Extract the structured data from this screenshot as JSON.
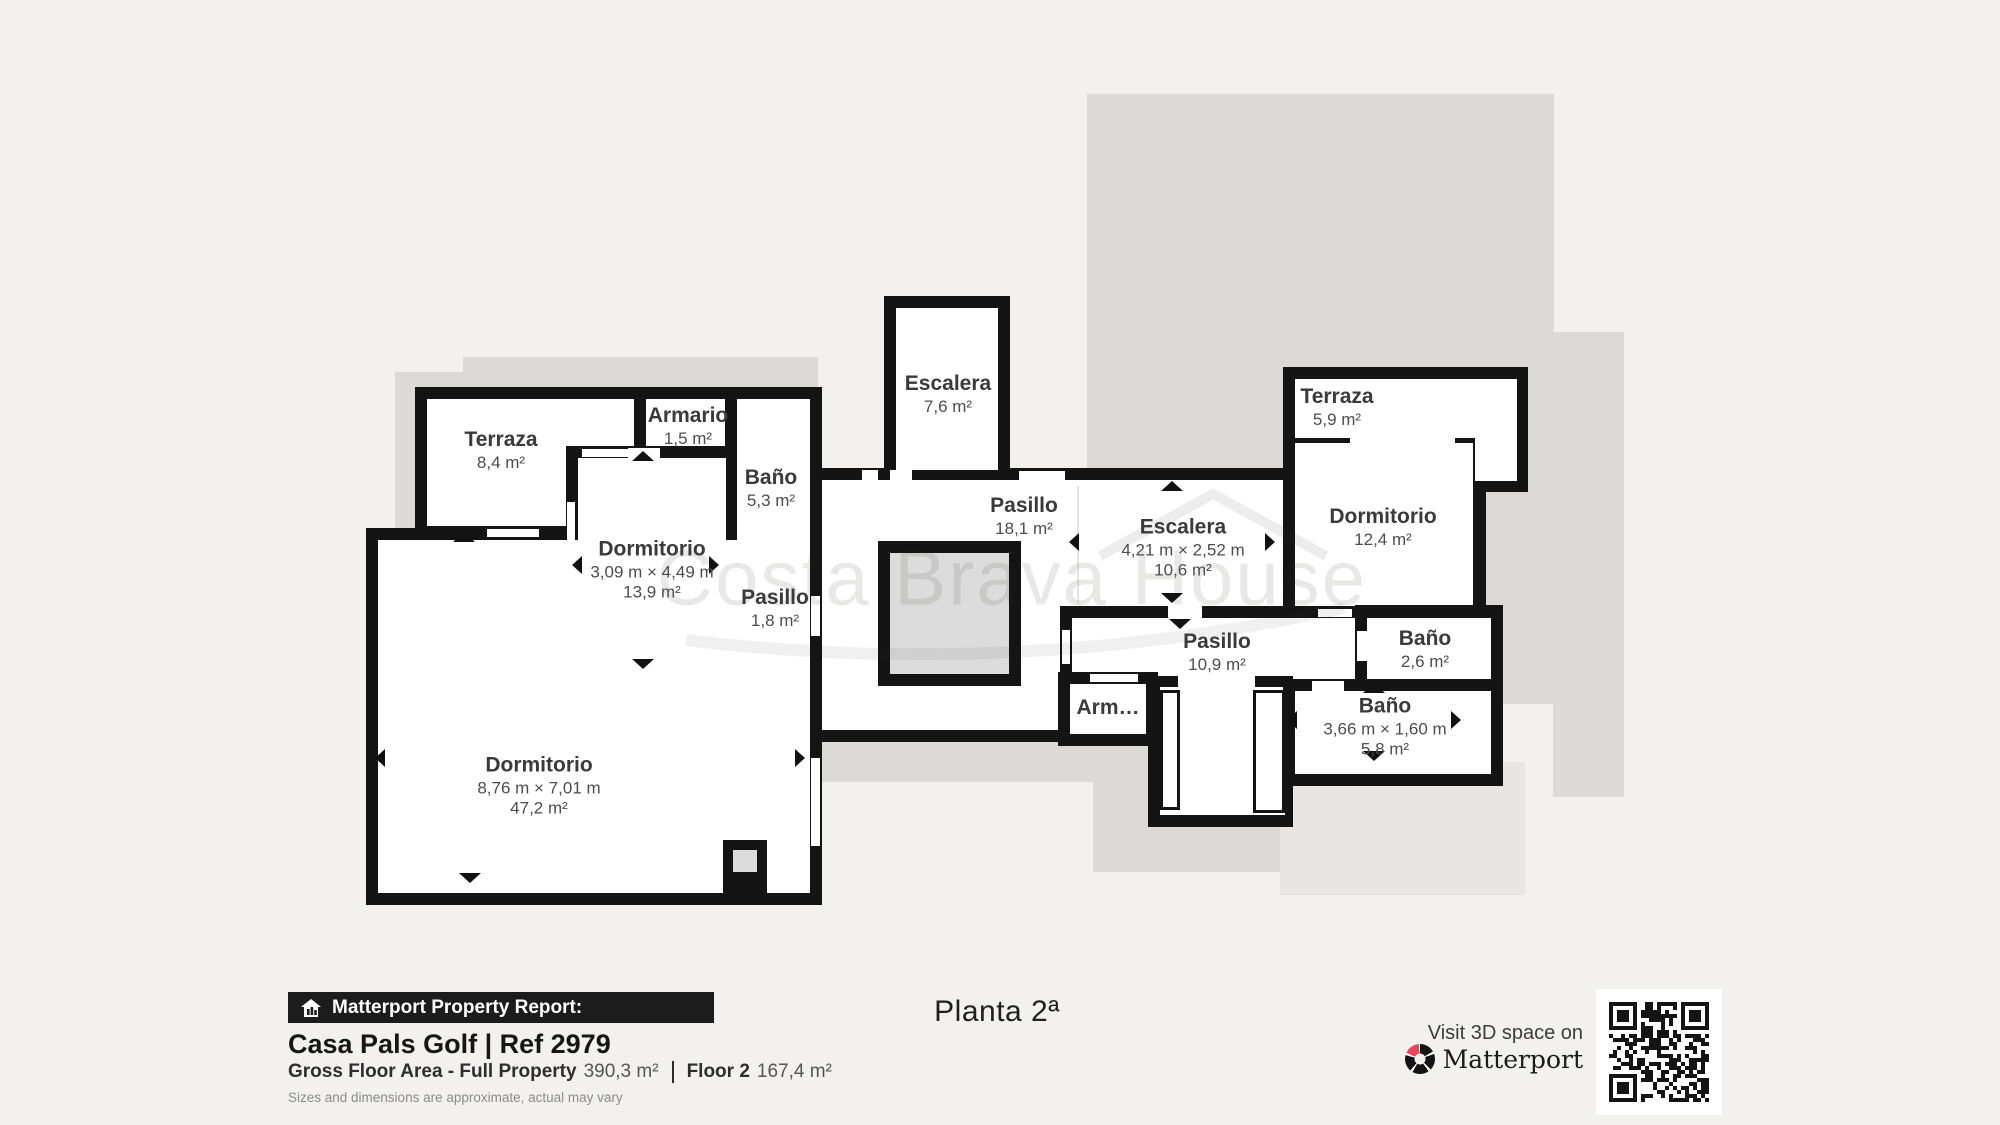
{
  "floor_title": "Planta 2ª",
  "watermark": "Costa Brava House",
  "rooms": [
    {
      "name": "Terraza",
      "area": "8,4 m²"
    },
    {
      "name": "Armario",
      "area": "1,5 m²"
    },
    {
      "name": "Baño",
      "area": "5,3 m²"
    },
    {
      "name": "Dormitorio",
      "dims": "3,09 m × 4,49 m",
      "area": "13,9 m²"
    },
    {
      "name": "Pasillo",
      "area": "1,8 m²"
    },
    {
      "name": "Dormitorio",
      "dims": "8,76 m × 7,01 m",
      "area": "47,2 m²"
    },
    {
      "name": "Escalera",
      "area": "7,6 m²"
    },
    {
      "name": "Pasillo",
      "area": "18,1 m²"
    },
    {
      "name": "Escalera",
      "dims": "4,21 m × 2,52 m",
      "area": "10,6 m²"
    },
    {
      "name": "Terraza",
      "area": "5,9 m²"
    },
    {
      "name": "Dormitorio",
      "area": "12,4 m²"
    },
    {
      "name": "Baño",
      "area": "2,6 m²"
    },
    {
      "name": "Pasillo",
      "area": "10,9 m²"
    },
    {
      "name": "Arm…"
    },
    {
      "name": "Baño",
      "dims": "3,66 m × 1,60 m",
      "area": "5,8 m²"
    }
  ],
  "report": {
    "bar_label": "Matterport Property Report:",
    "property_name": "Casa Pals Golf | Ref 2979",
    "gross_label": "Gross Floor Area - Full Property",
    "gross_value": "390,3 m²",
    "floor_label": "Floor 2",
    "floor_value": "167,4 m²",
    "disclaimer": "Sizes and dimensions are approximate, actual may vary"
  },
  "cta": {
    "visit_label": "Visit 3D space on",
    "brand": "Matterport"
  },
  "colors": {
    "background": "#f2f1ee",
    "wall": "#141414",
    "underlay_gray": "#dbdad7",
    "brand_red": "#e8465a"
  }
}
